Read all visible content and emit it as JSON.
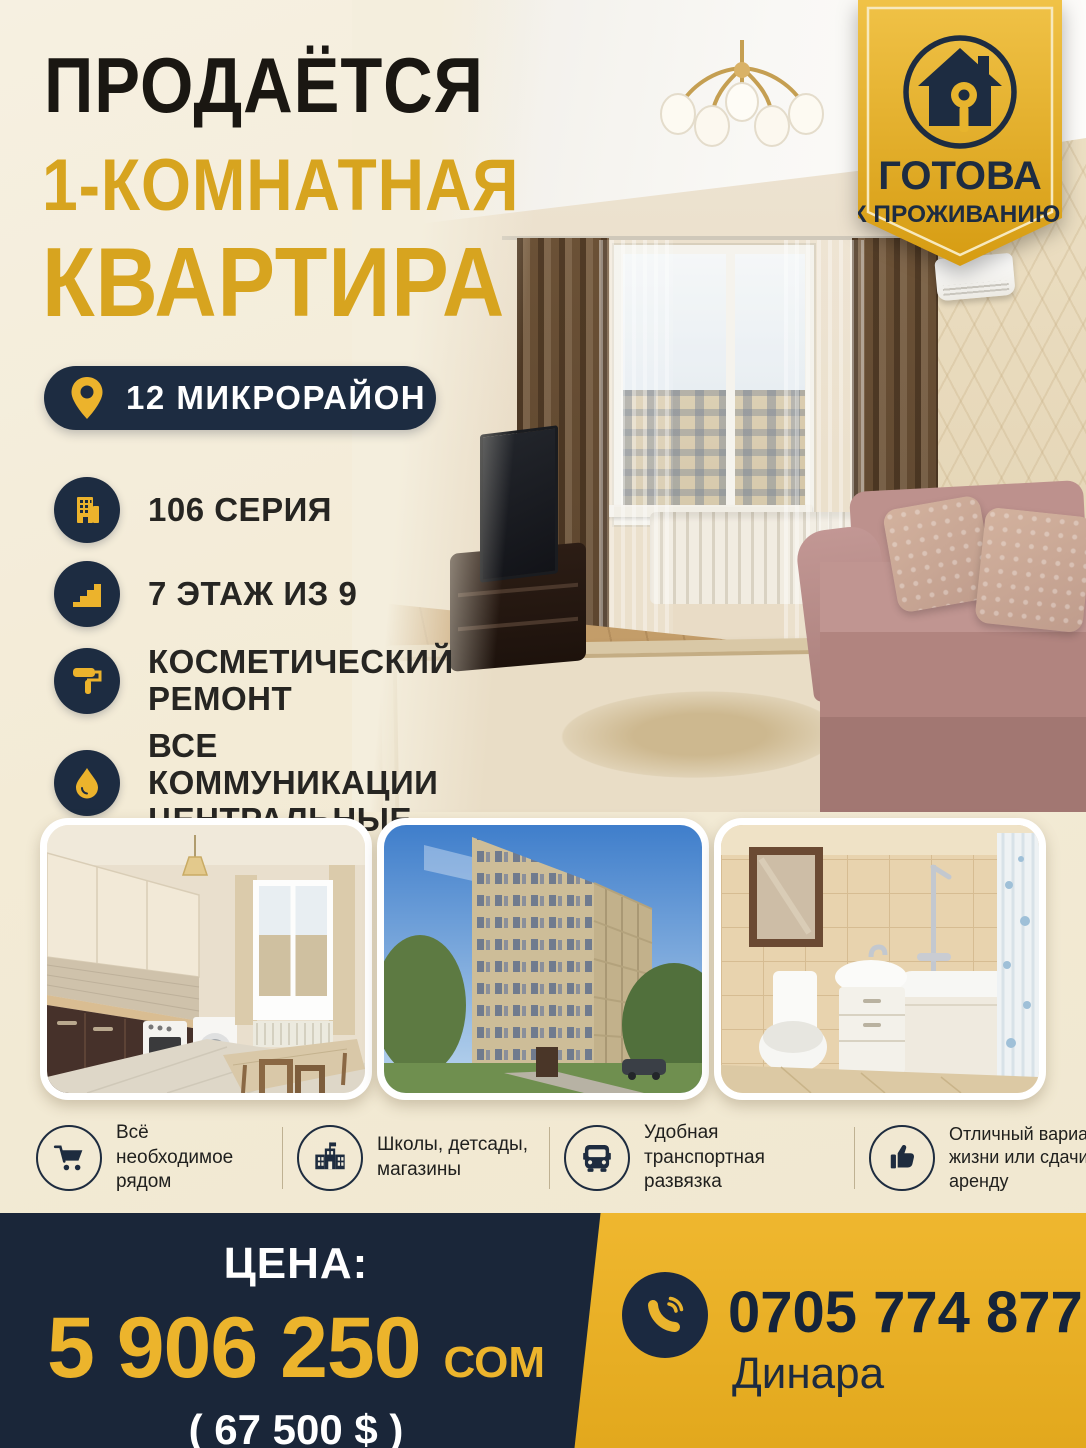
{
  "poster": {
    "title_line1": "ПРОДАЁТСЯ",
    "title_line2": "1-КОМНАТНАЯ",
    "title_line3": "КВАРТИРА",
    "location": "12 МИКРОРАЙОН",
    "ribbon": {
      "line1": "ГОТОВА",
      "line2": "К ПРОЖИВАНИЮ!"
    },
    "features": [
      {
        "icon": "building-icon",
        "text": "106 СЕРИЯ"
      },
      {
        "icon": "stairs-icon",
        "text": "7 ЭТАЖ ИЗ 9"
      },
      {
        "icon": "paint-roller-icon",
        "text": "КОСМЕТИЧЕСКИЙ РЕМОНТ"
      },
      {
        "icon": "water-drop-icon",
        "text": "ВСЕ КОММУНИКАЦИИ ЦЕНТРАЛЬНЫЕ"
      }
    ],
    "photos": {
      "main": "living-room",
      "cards": [
        "kitchen",
        "building-exterior",
        "bathroom"
      ]
    },
    "highlights": [
      {
        "icon": "cart-icon",
        "text": "Всё необходимое рядом"
      },
      {
        "icon": "school-icon",
        "text": "Школы, детсады, магазины"
      },
      {
        "icon": "bus-icon",
        "text": "Удобная транспортная развязка"
      },
      {
        "icon": "thumbs-up-icon",
        "text": "Отличный вариант для жизни или сдачи в аренду"
      }
    ],
    "price": {
      "label": "ЦЕНА:",
      "amount": "5 906 250",
      "currency": "СОМ",
      "usd": "( 67 500 $ )"
    },
    "contact": {
      "phone": "0705 774 877",
      "name": "Динара"
    },
    "colors": {
      "cream": "#f4edda",
      "gold": "#d7a41f",
      "gold_bright": "#ecb42c",
      "navy": "#1d2c41"
    }
  }
}
